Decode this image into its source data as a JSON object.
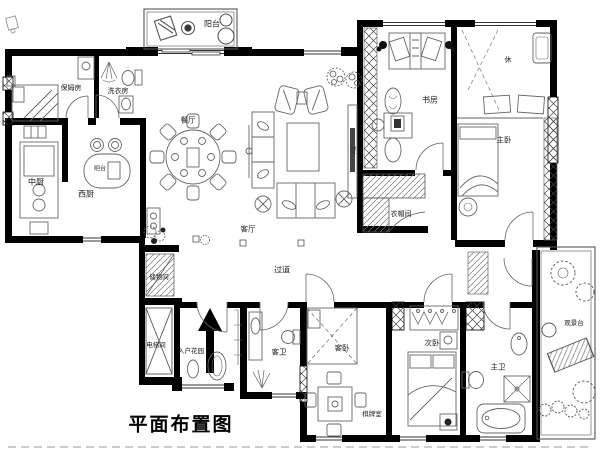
{
  "title": {
    "text": "平面布置图"
  },
  "rooms": [
    {
      "id": "balcony",
      "label": "阳台"
    },
    {
      "id": "nanny-room",
      "label": "保姆房"
    },
    {
      "id": "laundry-room",
      "label": "洗衣房"
    },
    {
      "id": "chinese-kitchen",
      "label": "中厨"
    },
    {
      "id": "western-kitchen",
      "label": "西厨"
    },
    {
      "id": "bar-counter",
      "label": "吧台"
    },
    {
      "id": "dining-room",
      "label": "餐厅"
    },
    {
      "id": "living-room",
      "label": "客厅"
    },
    {
      "id": "study",
      "label": "书房"
    },
    {
      "id": "cloakroom",
      "label": "衣帽间"
    },
    {
      "id": "leisure-area",
      "label": "休"
    },
    {
      "id": "master-bedroom",
      "label": "主卧"
    },
    {
      "id": "corridor",
      "label": "过道"
    },
    {
      "id": "storage-room",
      "label": "储物间"
    },
    {
      "id": "elevator-room",
      "label": "电梯间"
    },
    {
      "id": "entry-garden",
      "label": "入户花园"
    },
    {
      "id": "guest-bathroom",
      "label": "客卫"
    },
    {
      "id": "guest-bedroom",
      "label": "客卧"
    },
    {
      "id": "mahjong-room",
      "label": "棋牌室"
    },
    {
      "id": "second-bedroom",
      "label": "次卧"
    },
    {
      "id": "master-bathroom",
      "label": "主卫"
    },
    {
      "id": "viewing-terrace",
      "label": "观景台"
    }
  ],
  "annotations": {
    "tv_label": "TV"
  },
  "colors": {
    "wall": "#000000",
    "furniture_line": "#666666",
    "label_text": "#222222"
  }
}
